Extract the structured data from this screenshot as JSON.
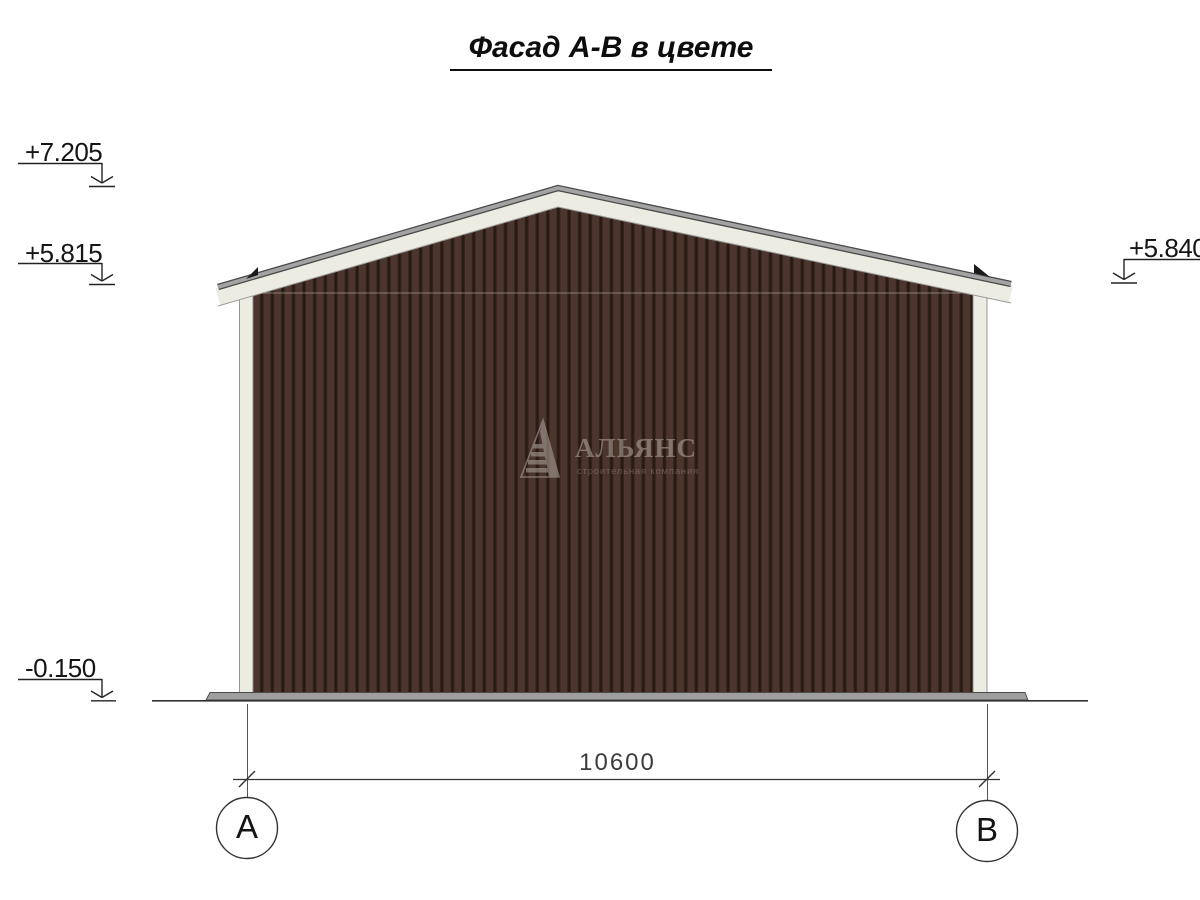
{
  "title": "Фасад А-В в цвете",
  "elevation_marks": {
    "ridge": "+7.205",
    "eave_left": "+5.815",
    "eave_right": "+5.840",
    "ground": "-0.150"
  },
  "dimensions": {
    "overall_width": "10600"
  },
  "axes": {
    "left": "А",
    "right": "В"
  },
  "watermark": {
    "company": "АЛЬЯНС",
    "tagline": "строительная компания"
  },
  "colors": {
    "siding_main": "#4b352d",
    "siding_groove": "#261a13",
    "siding_edge": "#33231c",
    "trim": "#edece3",
    "roof_edge_fill": "#a3a3a3",
    "roof_edge_line": "#4a4a4a",
    "base_plinth": "#9e9e9e",
    "line_dark": "#222222",
    "watermark_gray": "#a89e96"
  }
}
